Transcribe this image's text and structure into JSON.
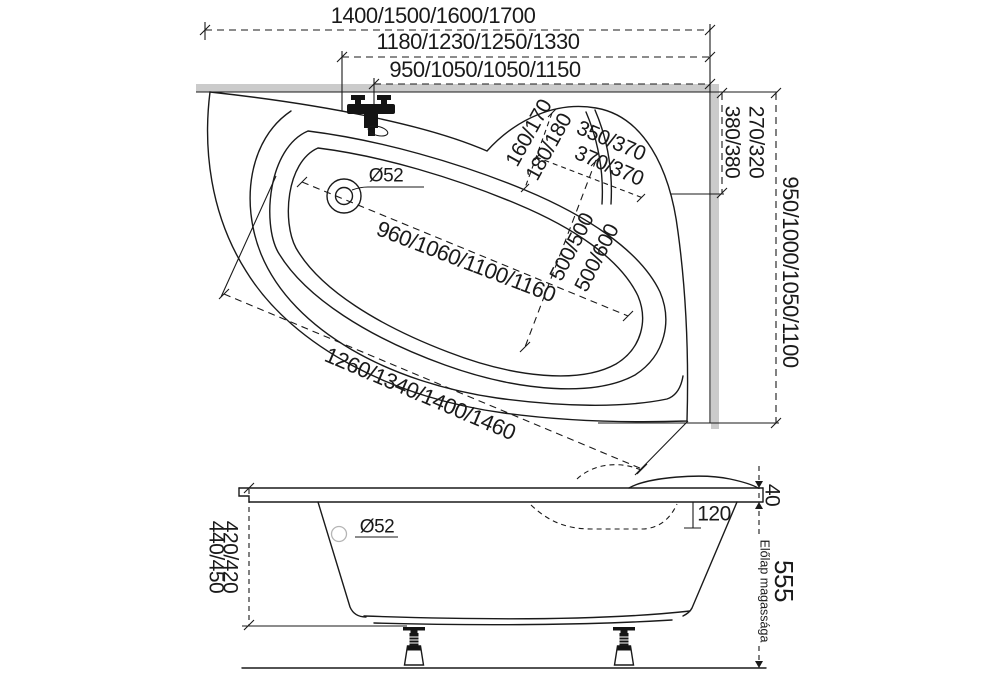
{
  "drawing": {
    "title": "Corner bathtub dimensional drawing",
    "colors": {
      "line": "#1a1a1a",
      "wall": "#cbcbcb",
      "background": "#ffffff"
    },
    "top_view": {
      "overall_length": "1400/1500/1600/1700",
      "inner_length": "1180/1230/1250/1330",
      "faucet_position": "950/1050/1050/1150",
      "wall_side_length": "950/1000/1050/1100",
      "corner_offset_a": "270/320",
      "corner_offset_b": "380/380",
      "headrest_dims": {
        "a": "160/170",
        "b": "180/180",
        "c": "350/370",
        "d": "370/370"
      },
      "well_length": "960/1060/1100/1160",
      "well_width_a": "500/500",
      "well_width_b": "500/600",
      "diagonal_length": "1260/1340/1400/1460",
      "drain_diameter": "Ø52"
    },
    "side_view": {
      "drain_diameter": "Ø52",
      "rim_thickness": "40",
      "seat_depth": "120",
      "depth_a": "420/420",
      "depth_b": "440/450",
      "panel_height": "555",
      "panel_height_label": "Előlap magassága"
    }
  }
}
